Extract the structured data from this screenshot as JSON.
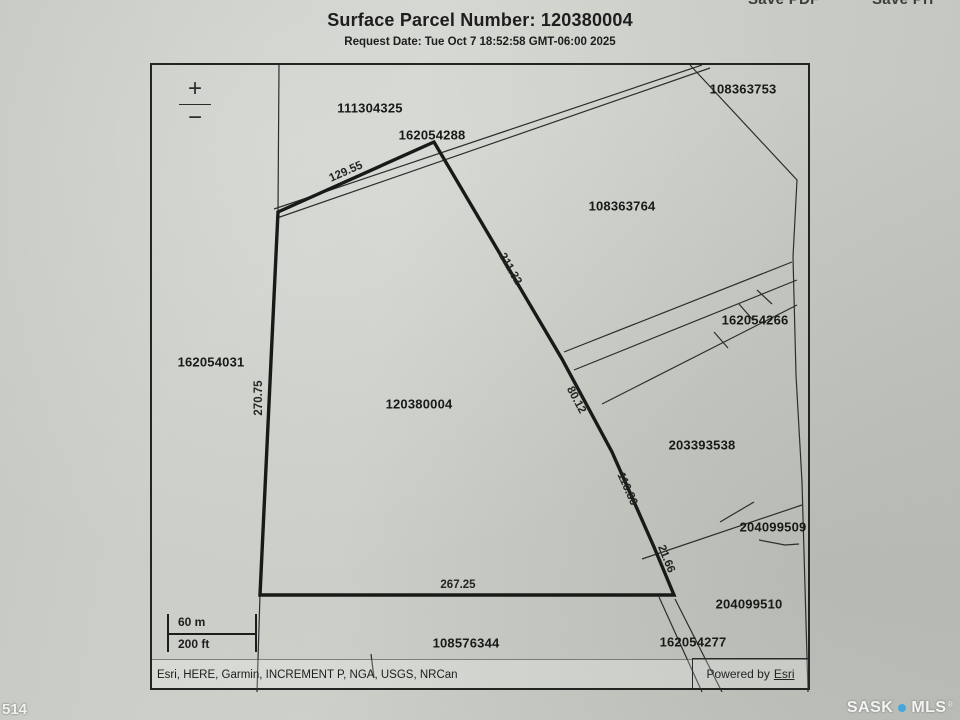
{
  "colors": {
    "paper": "#ced1ca",
    "ink": "#1e1e1e",
    "brand_dot": "#45a7dd"
  },
  "top_cropped": {
    "left": "Save PDF",
    "right": "Save Pri"
  },
  "header": {
    "title": "Surface Parcel Number: 120380004",
    "request_date": "Request Date: Tue Oct 7 18:52:58 GMT-06:00 2025"
  },
  "map": {
    "zoom_in": "+",
    "zoom_out": "−",
    "scale": {
      "metric": "60 m",
      "imperial": "200 ft"
    },
    "attribution": "Esri, HERE, Garmin, INCREMENT P, NGA, USGS, NRCan",
    "powered_by": {
      "prefix": "Powered by",
      "brand": "Esri"
    },
    "parcels": [
      "111304325",
      "162054288",
      "108363753",
      "108363764",
      "162054266",
      "162054031",
      "120380004",
      "203393538",
      "204099509",
      "204099510",
      "108576344",
      "162054277"
    ],
    "measurements": [
      "129.55",
      "211.32",
      "270.75",
      "80.12",
      "116.86",
      "21.66",
      "267.25"
    ]
  },
  "footer": {
    "page_number": "514",
    "brand": {
      "sask": "SASK",
      "mls": "MLS",
      "reg": "®"
    }
  }
}
